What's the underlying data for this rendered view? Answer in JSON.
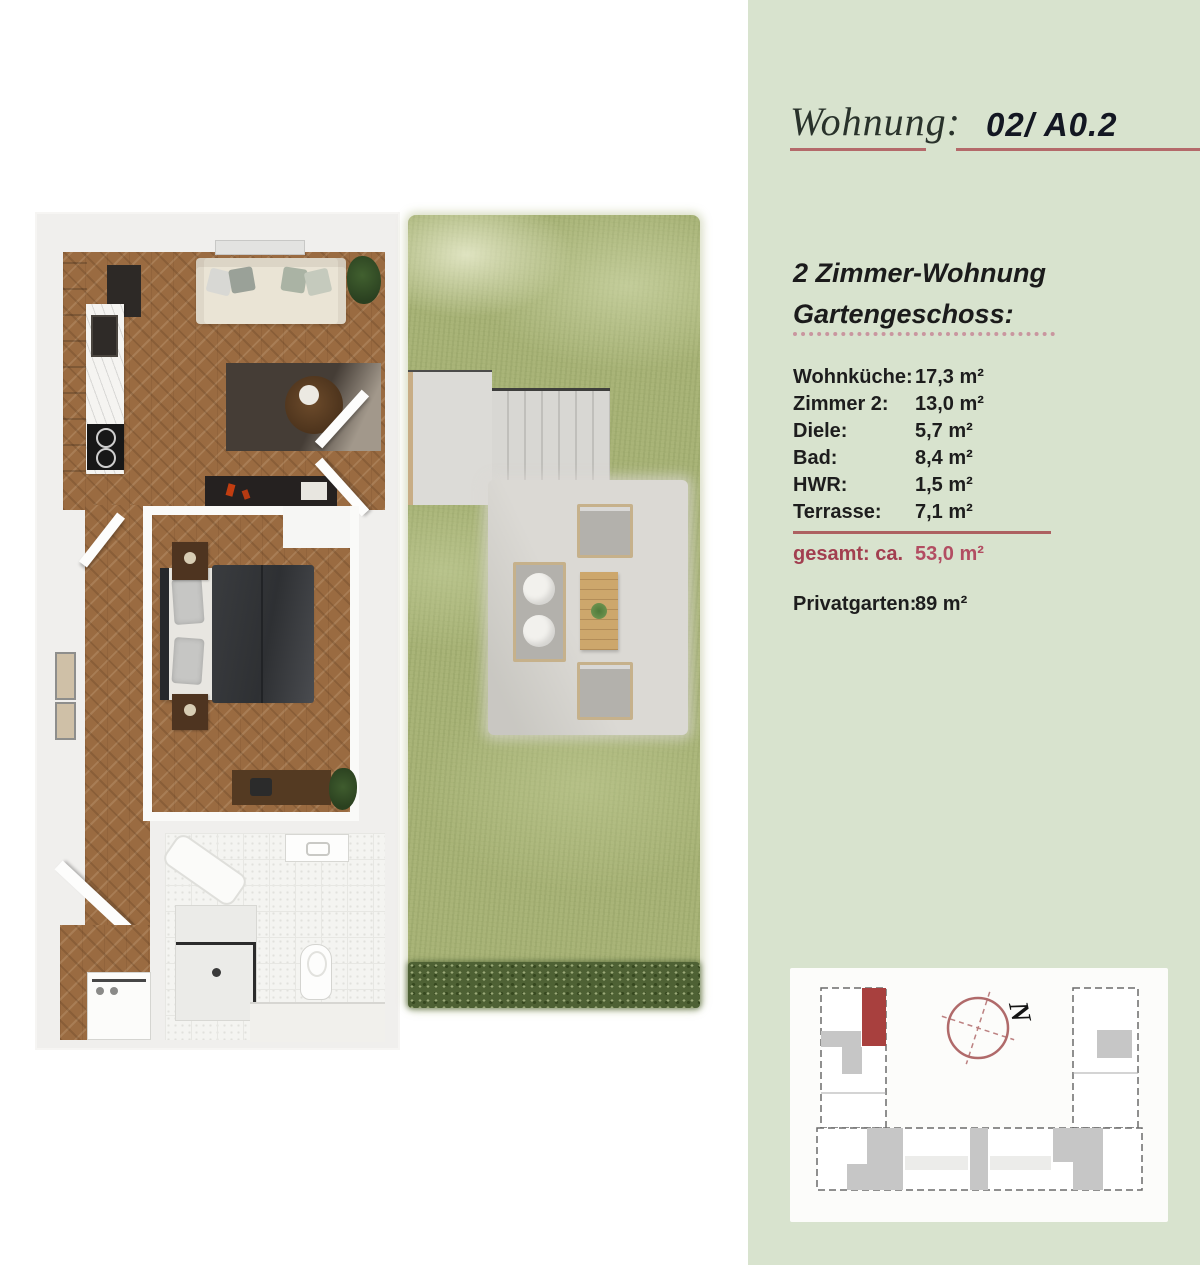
{
  "header": {
    "label": "Wohnung:",
    "unit": "02/ A0.2"
  },
  "apartment": {
    "type_line1": "2 Zimmer-Wohnung",
    "type_line2": "Gartengeschoss:",
    "rooms": [
      {
        "label": "Wohnküche:",
        "value": "17,3 m²"
      },
      {
        "label": "Zimmer 2:",
        "value": "13,0 m²"
      },
      {
        "label": "Diele:",
        "value": "5,7 m²"
      },
      {
        "label": "Bad:",
        "value": "8,4 m²"
      },
      {
        "label": "HWR:",
        "value": "1,5 m²"
      },
      {
        "label": "Terrasse:",
        "value": "7,1 m²"
      }
    ],
    "total": {
      "label": "gesamt: ca.",
      "value": "53,0 m²"
    },
    "garden": {
      "label": "Privatgarten:",
      "value": "89 m²"
    }
  },
  "site_plan": {
    "compass_label": "N",
    "marker_color": "#a8403e"
  },
  "colors": {
    "panel_green": "#d8e3ce",
    "accent_red": "#b46a6a",
    "total_red": "#a23f50"
  }
}
